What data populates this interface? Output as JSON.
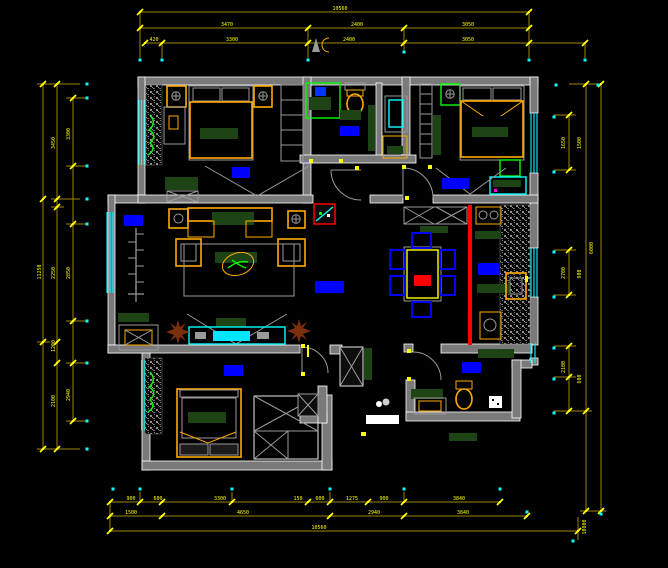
{
  "drawing": {
    "type": "cad-residential-floor-plan",
    "background": "#000000",
    "colors": {
      "wall": "#7a7a7a",
      "wall_edge": "#ffffff",
      "dimension_line": "#9f8400",
      "dimension_text": "#ffff00",
      "window": "#00ffff",
      "furniture_outline": "#ffaa00",
      "upholstery_dark_green": "#1e4416",
      "fixture_green": "#00ff00",
      "room_label_block": "#0000ff",
      "accent_red": "#ff0000",
      "plant_brown": "#7c2f0c",
      "detail_gray": "#9a9a9a"
    },
    "dims": {
      "top": {
        "r1": [
          "10560"
        ],
        "r2": [
          "3470",
          "2400",
          "3050"
        ],
        "r3": [
          "420",
          "3300",
          "2400",
          "3050"
        ]
      },
      "left": {
        "outer": [
          "11250"
        ],
        "mid": [
          "3450",
          "2250",
          "1200",
          "2100"
        ],
        "inner": [
          "3300",
          "2850",
          "2940"
        ]
      },
      "right": {
        "inner": [
          "1650",
          "2700",
          "2100"
        ],
        "inner2": [
          "1500",
          "900",
          "600"
        ],
        "mid": [
          "6000"
        ],
        "outer": [
          "10800"
        ]
      },
      "bottom": {
        "r1": [
          "900",
          "600",
          "3300",
          "150",
          "600",
          "1275",
          "900",
          "3840"
        ],
        "r2": [
          "1500",
          "4650",
          "2940",
          "3840"
        ],
        "r3": [
          "10560"
        ]
      }
    }
  }
}
